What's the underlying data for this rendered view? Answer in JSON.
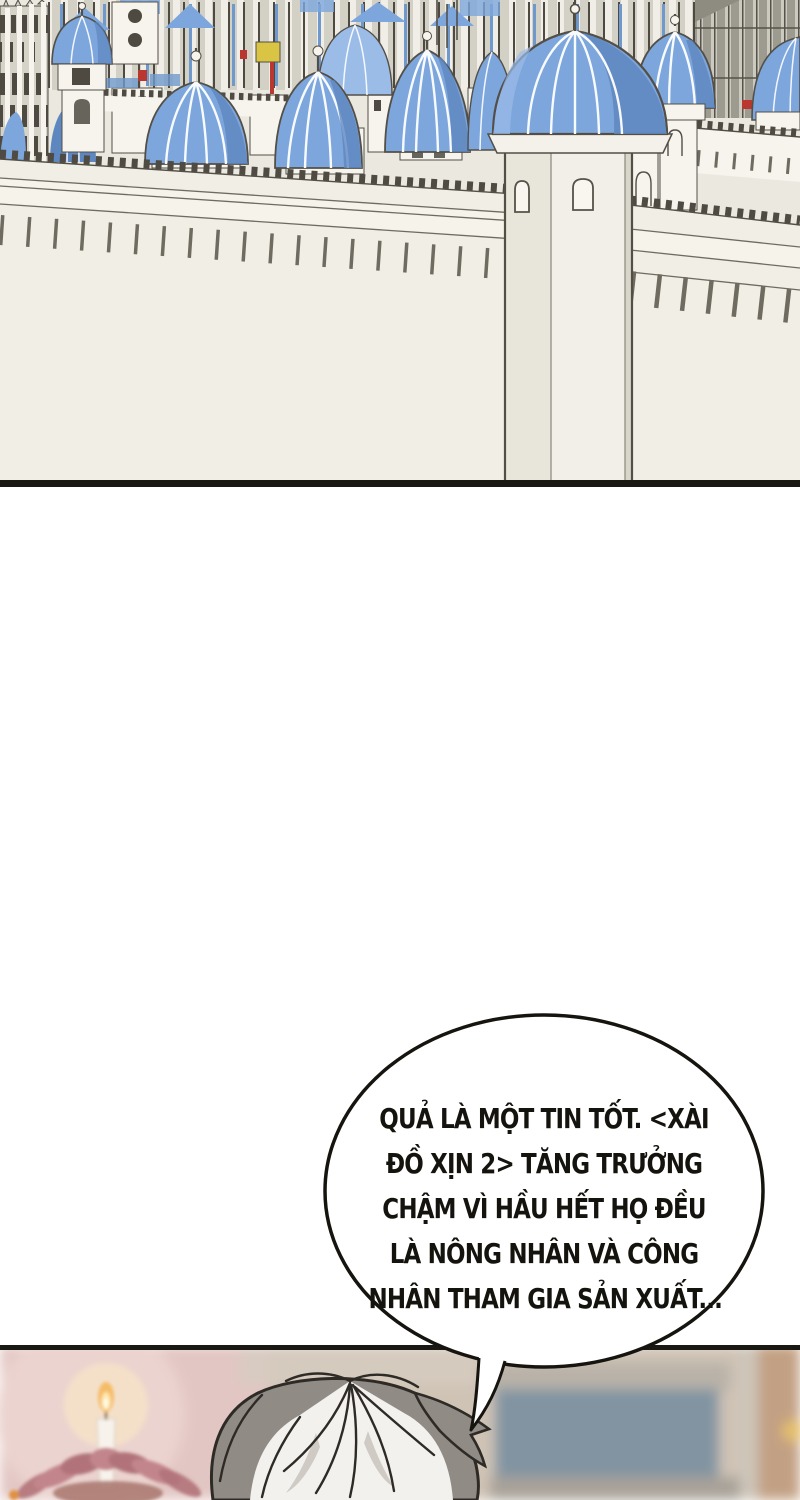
{
  "page": {
    "kind": "webtoon comic page",
    "width": 800,
    "height": 1500
  },
  "panels": {
    "castle": {
      "description": "Walled fantasy city skyline with many blue ribbed onion domes on white towers, crenellated ramparts with corbel teeth, a tall foreground gate tower, gothic cathedral at far left, grey columned structure at far right"
    },
    "room": {
      "description": "Blurred warm interior: lit candle on a pink lotus lamp at left, top of a character's grey-and-white spiky hair in the center, blue-grey blurred board and tan wall at right"
    }
  },
  "speech_bubble": {
    "lines": [
      "QUẢ LÀ MỘT TIN TỐT. <XÀI",
      "ĐỒ XỊN 2> TĂNG TRƯỞNG",
      "CHẬM VÌ HẦU HẾT HỌ ĐỀU",
      "LÀ NÔNG NHÂN VÀ CÔNG",
      "NHÂN THAM GIA SẢN XUẤT..."
    ],
    "full_text": "QUẢ LÀ MỘT TIN TỐT. <XÀI ĐỒ XỊN 2> TĂNG TRƯỞNG CHẬM VÌ HẦU HẾT HỌ ĐỀU LÀ NÔNG NHÂN VÀ CÔNG NHÂN THAM GIA SẢN XUẤT..."
  },
  "palette": {
    "paper": "#ffffff",
    "ink": "#191813",
    "cream": "#eae8df",
    "wall_light": "#f0eee5",
    "wall_band": "#f5f3ea",
    "white_struct": "#f6f4ec",
    "dome_blue": "#7da6dc",
    "dome_light": "#9cbce8",
    "dome_dark": "#5e87c0",
    "grey_struct": "#9d9a8f",
    "gothic_grey": "#d5d2c8",
    "arch_dark": "#4e4a42",
    "outline": "#534f47",
    "merlon_dark": "#4f4b43",
    "teeth": "#6f6b60",
    "accent_red": "#b9372e",
    "accent_yellow": "#d9c443",
    "accent_orange": "#e0913f",
    "room_pink": "#e2c6c3",
    "room_beige": "#cfc3b5",
    "room_bluegrey": "#8294a2",
    "room_tan": "#c2a083",
    "hair_grey": "#918b85",
    "hair_white": "#f3f1ed",
    "hair_outline": "#2e2b27",
    "flame_outer": "#f5b85c",
    "flame_core": "#fffdf2",
    "candle_white": "#f7f3ec",
    "lotus_pink": "#c2858b",
    "lotus_deep": "#b17379",
    "glow_warm": "#f6e3c8"
  }
}
